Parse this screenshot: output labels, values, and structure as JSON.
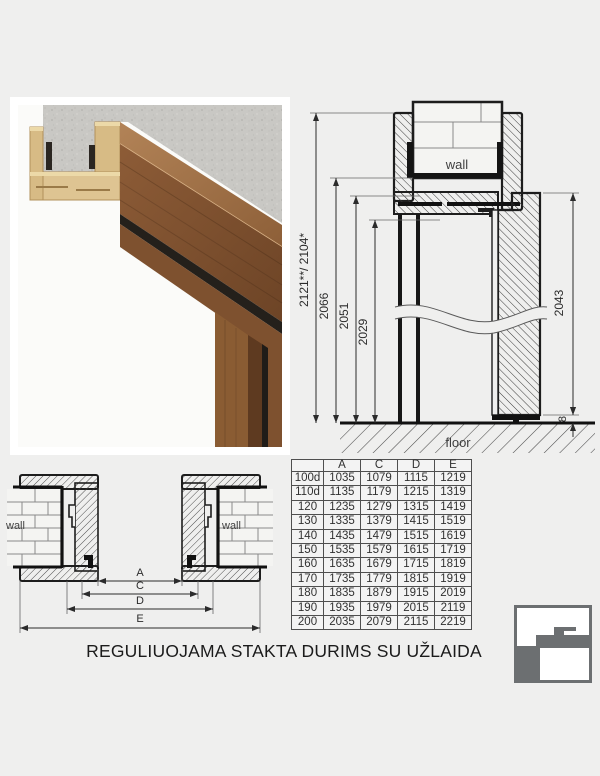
{
  "title": "REGULIUOJAMA STAKTA DURIMS SU UŽLAIDA",
  "colors": {
    "background": "#efefee",
    "line_black": "#1d1d1d",
    "dim_gray": "#3c3c3c",
    "logo_gray": "#6c6f71",
    "wood_dark": "#7a4c2c",
    "wood_light": "#dec492",
    "concrete_gray": "#c9c8c4",
    "seal_black": "#24201b"
  },
  "vertical_section": {
    "wall_label": "wall",
    "floor_label": "floor",
    "dims": {
      "overall": "2121**/ 2104*",
      "frame_outer": "2066",
      "frame_rebate": "2051",
      "clear_opening": "2029",
      "door_height": "2043",
      "bottom_gap": "8"
    }
  },
  "horizontal_section": {
    "wall_label_left": "wall",
    "wall_label_right": "wall",
    "dims": {
      "a": "A",
      "c": "C",
      "d": "D",
      "e": "E"
    }
  },
  "table": {
    "headers": [
      "",
      "A",
      "C",
      "D",
      "E"
    ],
    "rows": [
      [
        "100d",
        "1035",
        "1079",
        "1115",
        "1219"
      ],
      [
        "110d",
        "1135",
        "1179",
        "1215",
        "1319"
      ],
      [
        "120",
        "1235",
        "1279",
        "1315",
        "1419"
      ],
      [
        "130",
        "1335",
        "1379",
        "1415",
        "1519"
      ],
      [
        "140",
        "1435",
        "1479",
        "1515",
        "1619"
      ],
      [
        "150",
        "1535",
        "1579",
        "1615",
        "1719"
      ],
      [
        "160",
        "1635",
        "1679",
        "1715",
        "1819"
      ],
      [
        "170",
        "1735",
        "1779",
        "1815",
        "1919"
      ],
      [
        "180",
        "1835",
        "1879",
        "1915",
        "2019"
      ],
      [
        "190",
        "1935",
        "1979",
        "2015",
        "2119"
      ],
      [
        "200",
        "2035",
        "2079",
        "2115",
        "2219"
      ]
    ]
  },
  "logo": {
    "name": "door-frame-profile-logo"
  }
}
